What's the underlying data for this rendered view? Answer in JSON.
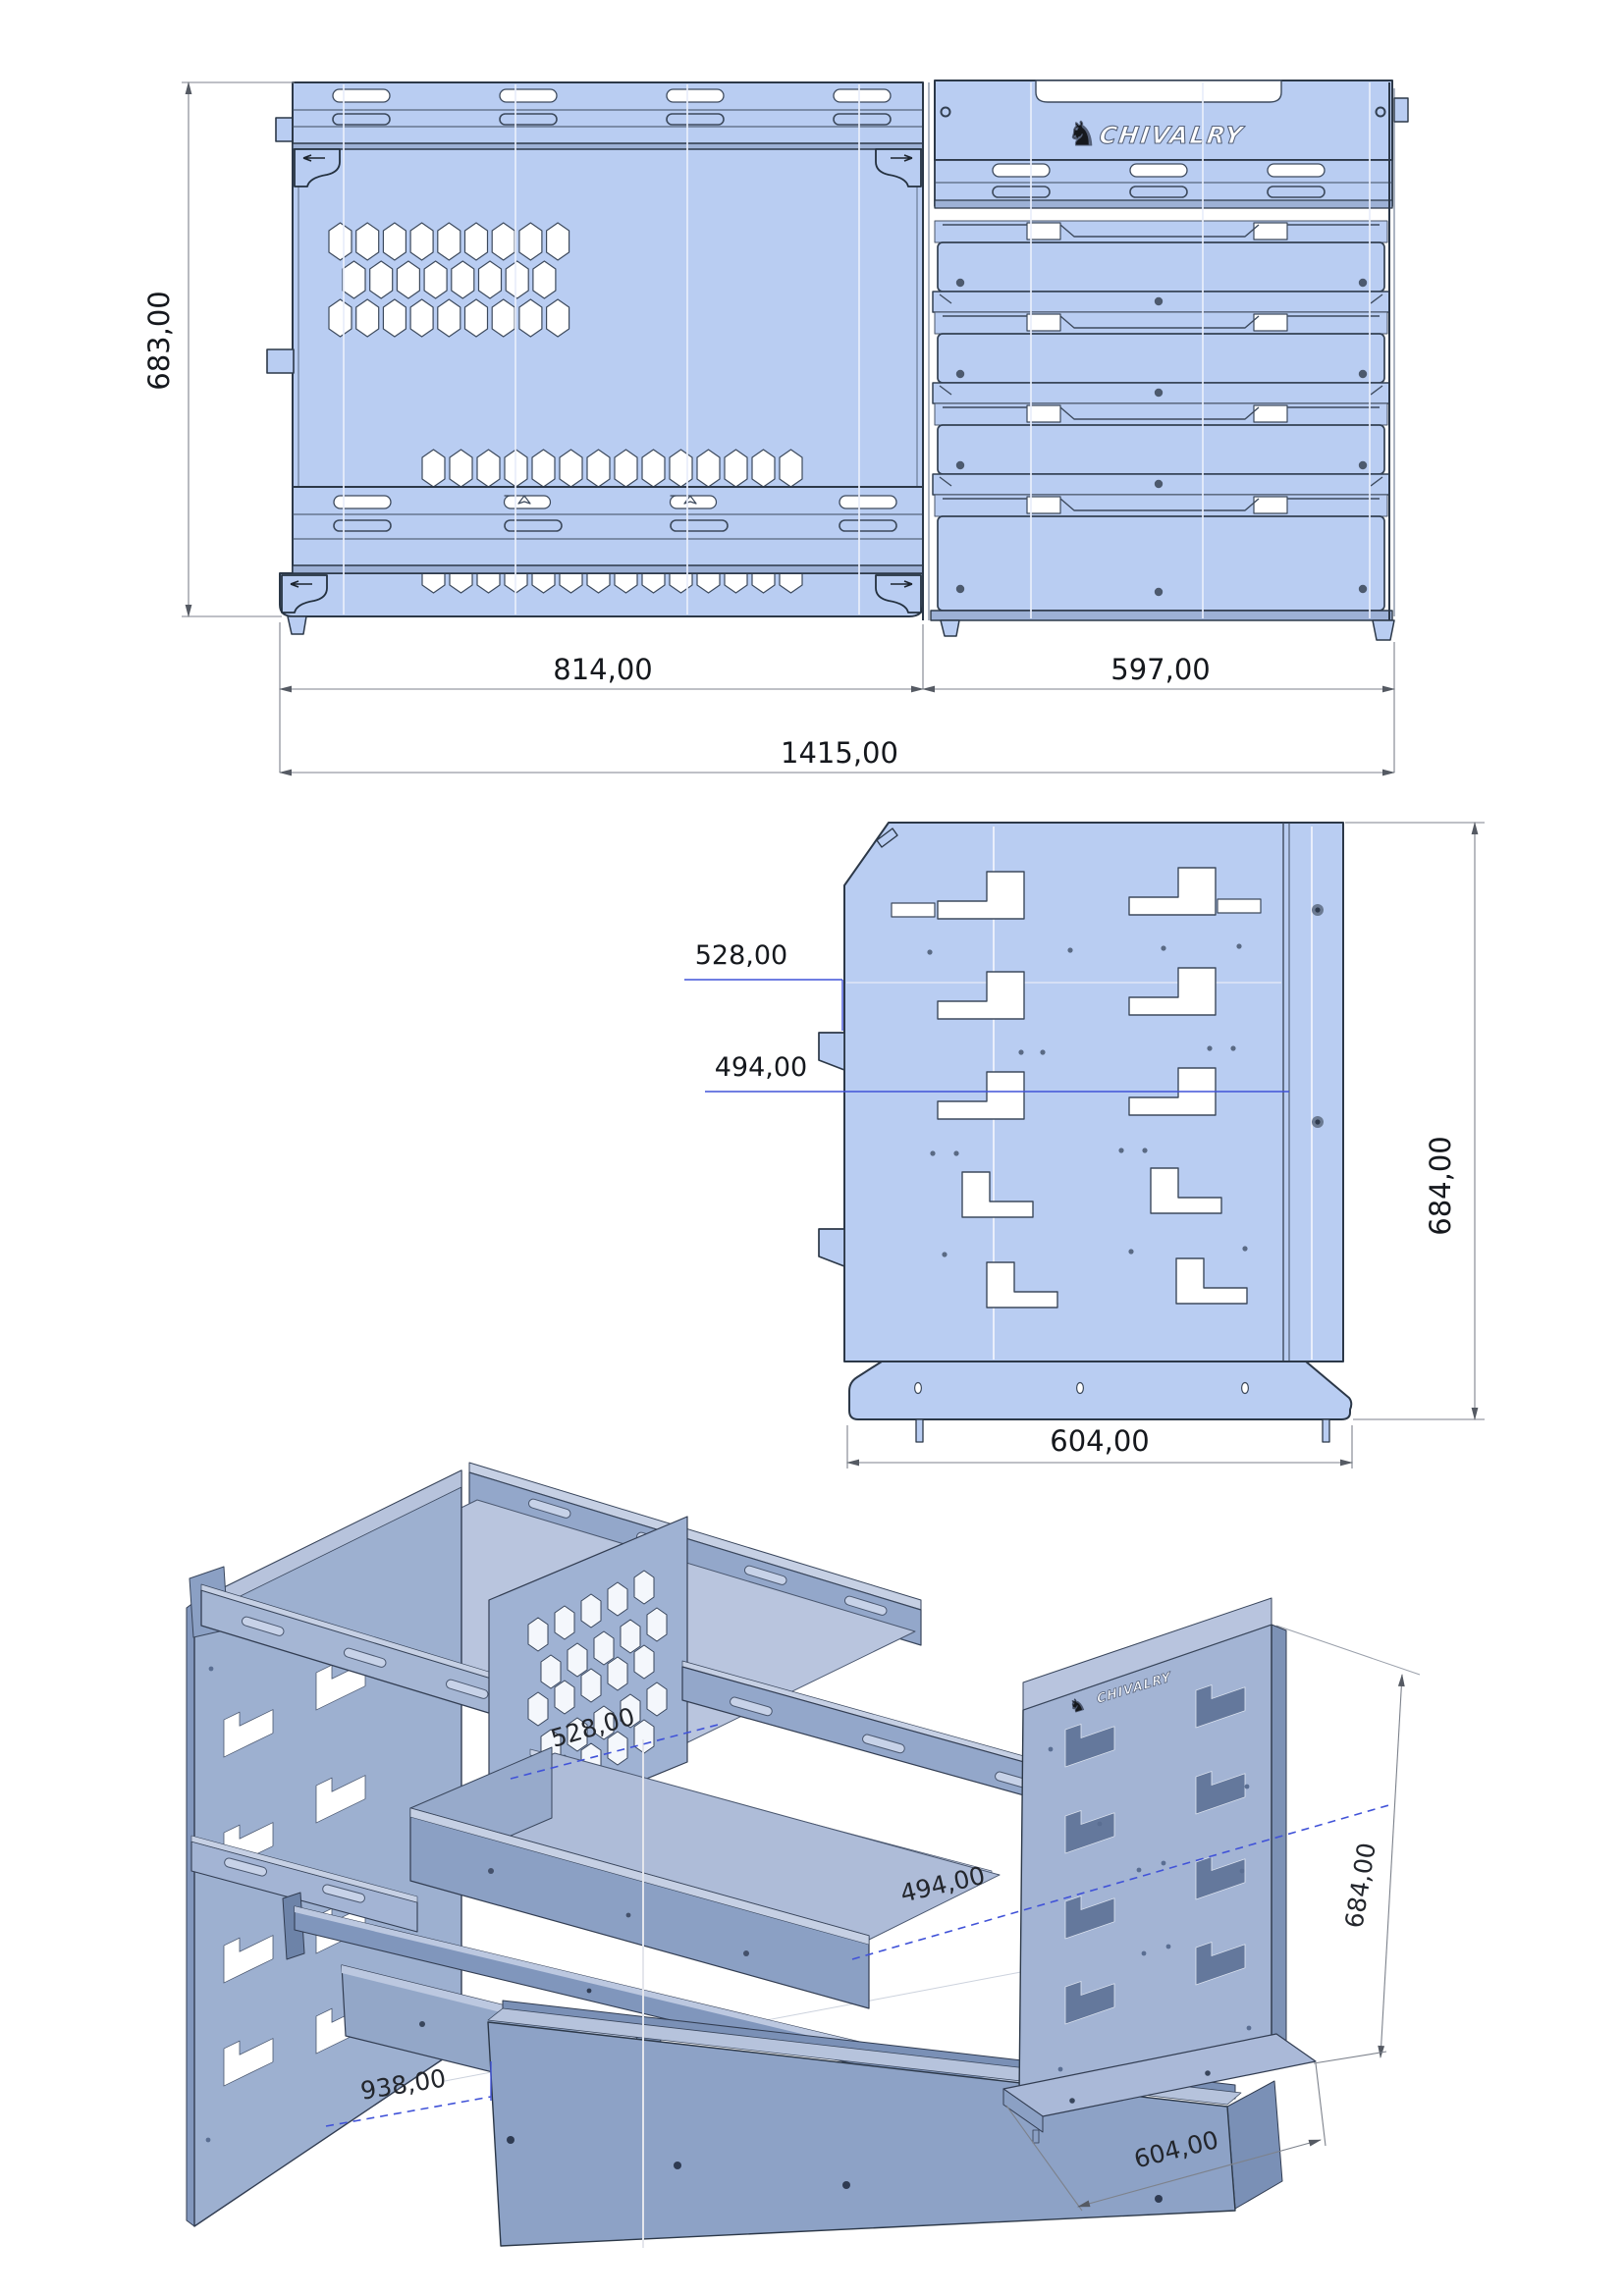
{
  "brand": {
    "name": "CHIVALRY",
    "knight_icon": "♞"
  },
  "colors": {
    "panel_fill": "#b9cdf2",
    "line": "#3d4a5d",
    "dim_blue": "#4153d8",
    "dim_gray": "#7d828c",
    "iso_mid": "#a3b4d4",
    "iso_light": "#b8c4de",
    "iso_dark": "#8297bd",
    "white": "#ffffff"
  },
  "views": {
    "front": {
      "title": "front-elevation",
      "logo": "CHIVALRY",
      "dimensions": {
        "height": "683,00",
        "left_module_width": "814,00",
        "right_module_width": "597,00",
        "total_width": "1415,00"
      }
    },
    "side": {
      "title": "side-elevation",
      "dimensions": {
        "upper_shelf_depth": "528,00",
        "lower_shelf_depth": "494,00",
        "height": "684,00",
        "base_depth": "604,00"
      }
    },
    "iso": {
      "title": "isometric-view",
      "logo": "CHIVALRY",
      "dimensions": {
        "upper_shelf_depth": "528,00",
        "lower_shelf_depth": "494,00",
        "front_width": "938,00",
        "height": "684,00",
        "base_depth": "604,00"
      }
    }
  }
}
